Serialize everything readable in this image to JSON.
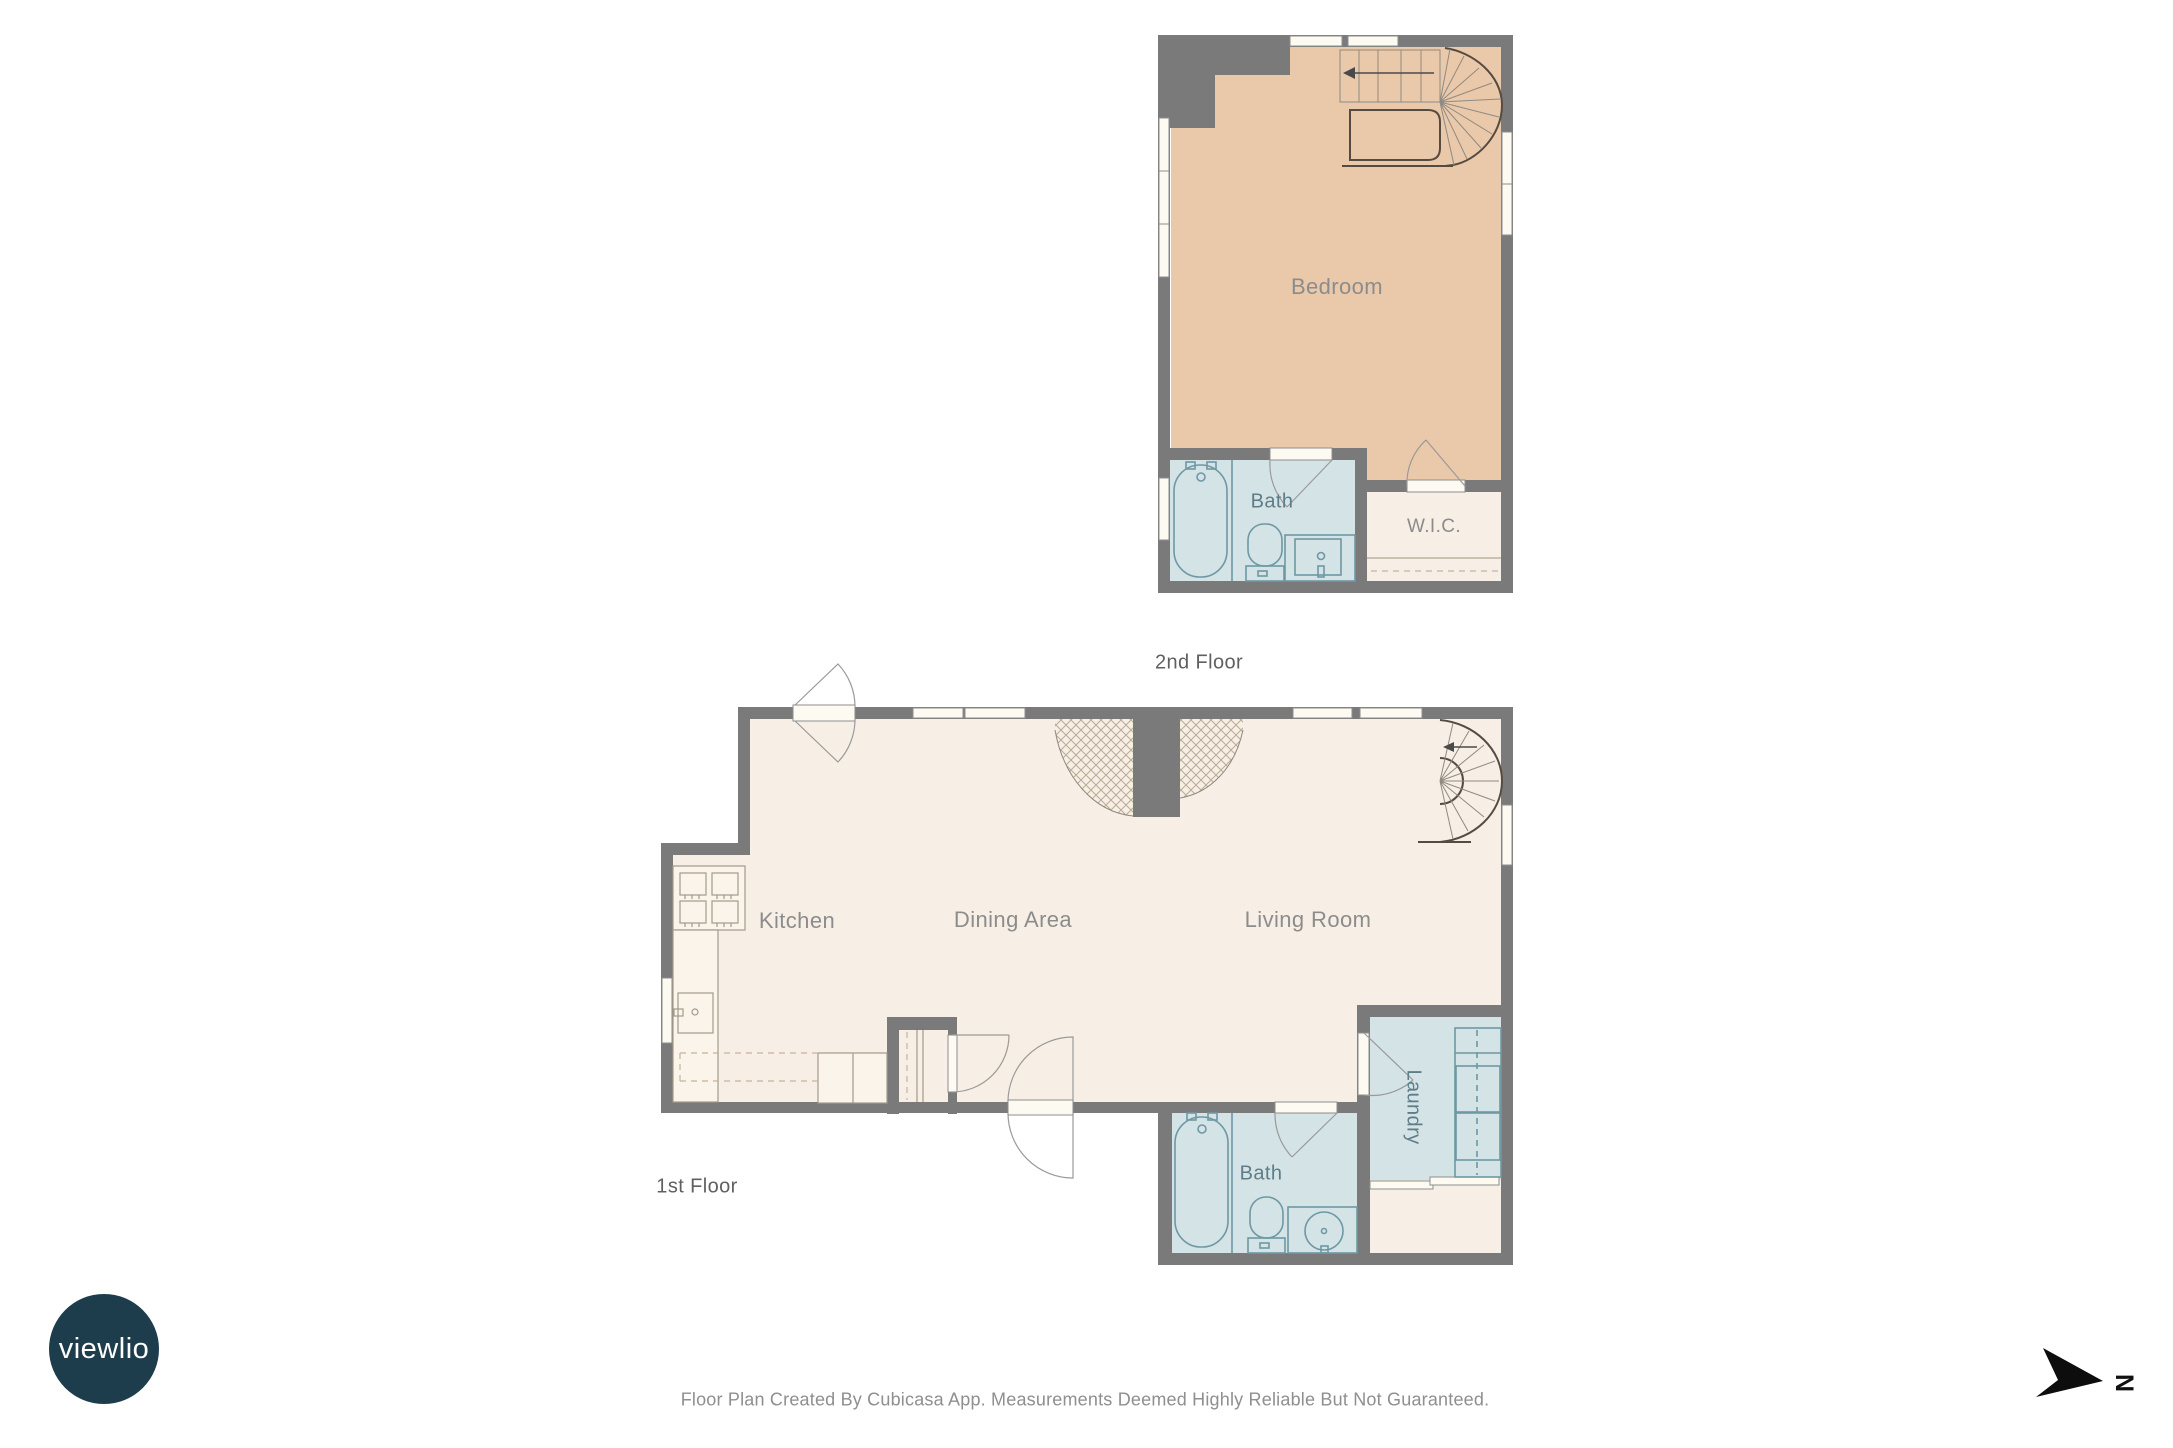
{
  "floors": {
    "second": {
      "title": "2nd Floor",
      "rooms": {
        "bedroom": "Bedroom",
        "bath": "Bath",
        "wic": "W.I.C."
      }
    },
    "first": {
      "title": "1st Floor",
      "rooms": {
        "kitchen": "Kitchen",
        "dining": "Dining Area",
        "living": "Living Room",
        "bath": "Bath",
        "laundry": "Laundry"
      }
    }
  },
  "branding": {
    "logo_text": "viewlio"
  },
  "compass": {
    "north_label": "N"
  },
  "footer": {
    "disclaimer": "Floor Plan Created By Cubicasa App. Measurements Deemed Highly Reliable But Not Guaranteed."
  },
  "colors": {
    "wall": "#7a7a7a",
    "floor_cream": "#f7efe6",
    "floor_peach": "#eac9ab",
    "floor_blue": "#d4e3e5",
    "window_fill": "#fdfaf2",
    "label_gray": "#8c8c8c",
    "label_slate": "#5f7d89",
    "title_gray": "#606060",
    "fixture_teal": "#6f98a4",
    "fixture_warm": "#a3998a",
    "logo_bg": "#1d3c4c"
  }
}
